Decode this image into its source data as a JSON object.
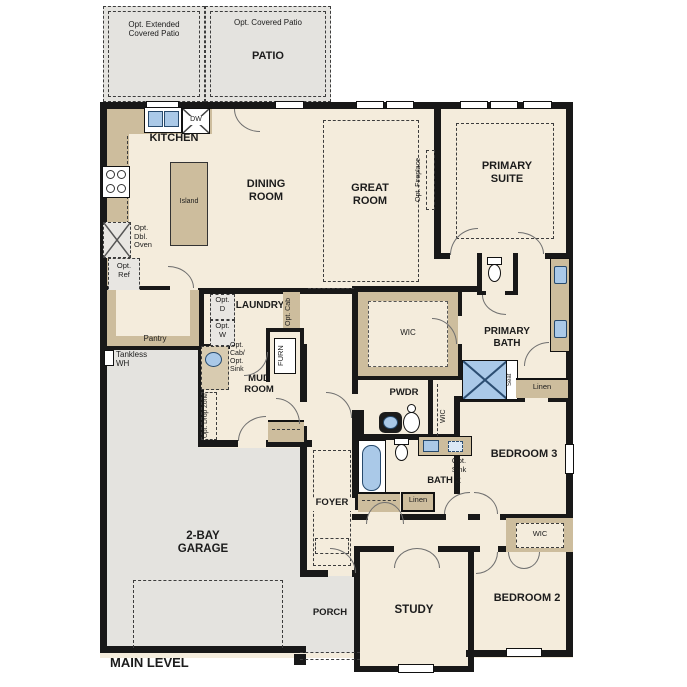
{
  "plan_title": "MAIN LEVEL",
  "colors": {
    "floor": "#f4ecdc",
    "millwork_tan": "#cdbd9d",
    "concrete_gray": "#e4e3df",
    "fixture_blue": "#aac9e8",
    "wall": "#181818"
  },
  "outdoor": {
    "patio_label": "PATIO",
    "opt_extended_patio": "Opt. Extended\nCovered Patio",
    "opt_covered_patio": "Opt. Covered Patio",
    "porch_label": "PORCH"
  },
  "kitchen": {
    "label": "KITCHEN",
    "island": "Island",
    "dishwasher": "DW",
    "opt_double_oven": "Opt.\nDbl.\nOven",
    "opt_refrigerator": "Opt.\nRef",
    "pantry": "Pantry"
  },
  "dining": {
    "label": "DINING\nROOM"
  },
  "great_room": {
    "label": "GREAT\nROOM",
    "opt_fireplace": "Opt. Fireplace"
  },
  "primary_suite": {
    "label": "PRIMARY\nSUITE"
  },
  "primary_bath": {
    "label": "PRIMARY\nBATH",
    "wic": "WIC",
    "shower_seat": "Seat",
    "linen": "Linen"
  },
  "laundry": {
    "label": "LAUNDRY",
    "opt_dryer": "Opt.\nD",
    "opt_washer": "Opt.\nW",
    "opt_cab": "Opt. Cab",
    "opt_cab_sink": "Opt.\nCab/\nOpt.\nSink",
    "furnace": "FURN"
  },
  "utility": {
    "tankless_wh": "Tankless\nWH"
  },
  "mud_room": {
    "label": "MUD\nROOM",
    "opt_drop_zone": "Opt. Drop Zone"
  },
  "powder": {
    "label": "PWDR"
  },
  "hall_wic": {
    "label": "WIC"
  },
  "bath2": {
    "label": "BATH 2",
    "opt_sink": "Opt.\nSink",
    "linen": "Linen"
  },
  "bedroom3": {
    "label": "BEDROOM 3"
  },
  "bedroom2": {
    "label": "BEDROOM 2",
    "wic": "WIC"
  },
  "foyer": {
    "label": "FOYER"
  },
  "garage": {
    "label": "2-BAY\nGARAGE"
  },
  "study": {
    "label": "STUDY"
  }
}
